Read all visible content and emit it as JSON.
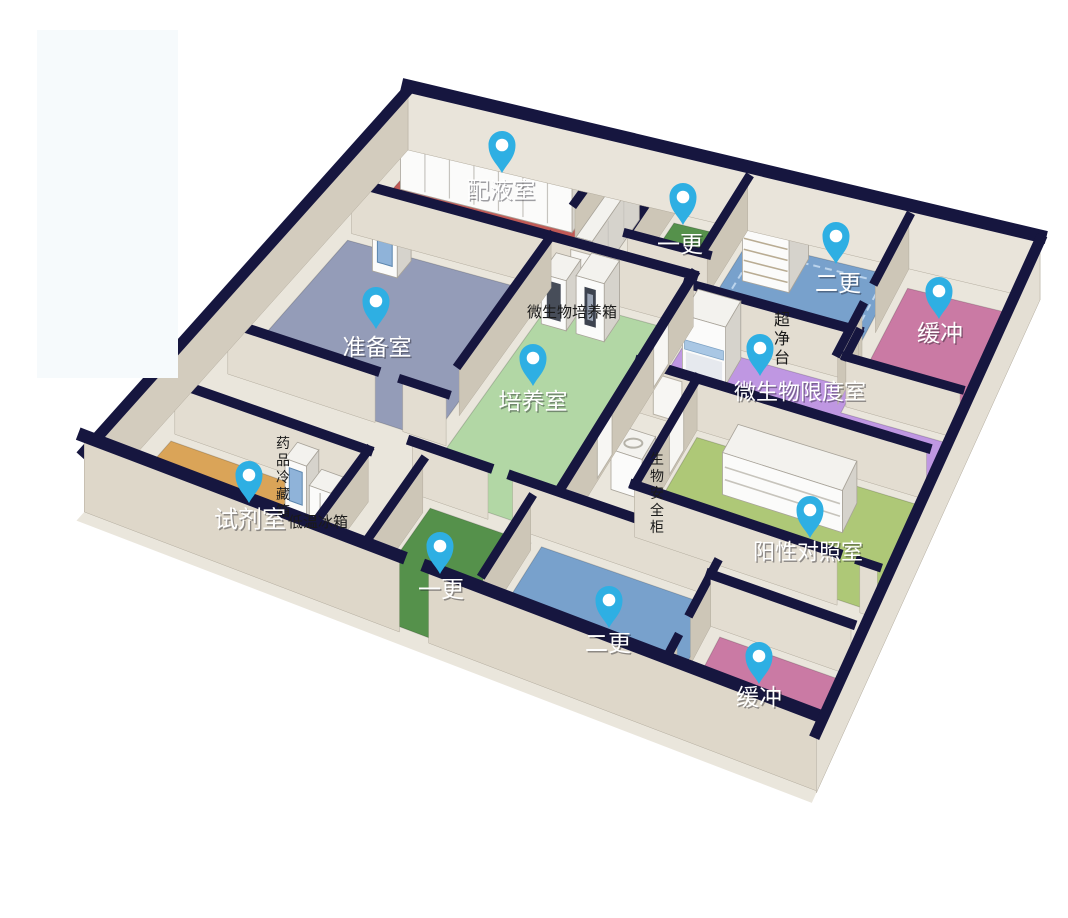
{
  "canvas": {
    "width": 1068,
    "height": 918,
    "background": "#ffffff"
  },
  "pin": {
    "color": "#2eafe3",
    "inner_color": "#ffffff"
  },
  "palette": {
    "wall_top": "#16163f",
    "wall_face_light": "#e7e1d6",
    "wall_face_dark": "#cdc6b7",
    "slab": "#eae6dc"
  },
  "rooms": [
    {
      "id": "peiye",
      "label": "配液室",
      "floor_color": "#c15a56",
      "pin": {
        "x": 502,
        "y": 172
      },
      "label_pos": {
        "x": 501,
        "y": 190
      },
      "label_size": 23,
      "poly": [
        [
          0.5,
          0.3
        ],
        [
          6.3,
          0.3
        ],
        [
          6.3,
          3.0
        ],
        [
          0.5,
          3.0
        ]
      ]
    },
    {
      "id": "yigeng-top",
      "label": "一更",
      "floor_color": "#55914b",
      "pin": {
        "x": 683,
        "y": 224
      },
      "label_pos": {
        "x": 680,
        "y": 244
      },
      "label_size": 23,
      "poly": [
        [
          8.6,
          0.3
        ],
        [
          10.6,
          0.3
        ],
        [
          10.6,
          2.3
        ],
        [
          8.6,
          2.3
        ]
      ]
    },
    {
      "id": "ergeng-top",
      "label": "二更",
      "floor_color": "#78a1cc",
      "pin": {
        "x": 836,
        "y": 263
      },
      "label_pos": {
        "x": 838,
        "y": 283
      },
      "label_size": 23,
      "poly": [
        [
          10.95,
          0.3
        ],
        [
          15.6,
          0.3
        ],
        [
          15.6,
          3.3
        ],
        [
          10.95,
          3.3
        ]
      ]
    },
    {
      "id": "huanchong-top",
      "label": "缓冲",
      "floor_color": "#ca7aa4",
      "pin": {
        "x": 939,
        "y": 318
      },
      "label_pos": {
        "x": 940,
        "y": 333
      },
      "label_size": 23,
      "poly": [
        [
          16.1,
          0.55
        ],
        [
          19.5,
          0.55
        ],
        [
          19.5,
          4.2
        ],
        [
          16.1,
          4.2
        ]
      ]
    },
    {
      "id": "zhunbei",
      "label": "准备室",
      "floor_color": "#949cb8",
      "pin": {
        "x": 376,
        "y": 328
      },
      "label_pos": {
        "x": 377,
        "y": 347
      },
      "label_size": 23,
      "poly": [
        [
          0.5,
          3.45
        ],
        [
          6.3,
          3.45
        ],
        [
          6.3,
          8.75
        ],
        [
          0.5,
          8.75
        ]
      ]
    },
    {
      "id": "peiyang",
      "label": "培养室",
      "floor_color": "#b2d7a5",
      "pin": {
        "x": 533,
        "y": 385
      },
      "label_pos": {
        "x": 533,
        "y": 401
      },
      "label_size": 23,
      "poly": [
        [
          6.8,
          3.45
        ],
        [
          10.85,
          3.45
        ],
        [
          10.85,
          10.3
        ],
        [
          6.8,
          10.3
        ]
      ]
    },
    {
      "id": "weishengwu-xiandu",
      "label": "微生物限度室",
      "floor_color": "#bf97e2",
      "pin": {
        "x": 760,
        "y": 375
      },
      "label_pos": {
        "x": 800,
        "y": 392
      },
      "label_size": 22,
      "poly": [
        [
          10.95,
          3.7
        ],
        [
          16.05,
          3.7
        ],
        [
          16.05,
          4.45
        ],
        [
          19.5,
          4.45
        ],
        [
          19.5,
          5.95
        ],
        [
          10.95,
          5.95
        ]
      ]
    },
    {
      "id": "shiji",
      "label": "试剂室",
      "floor_color": "#daa458",
      "pin": {
        "x": 249,
        "y": 502
      },
      "label_pos": {
        "x": 250,
        "y": 519
      },
      "label_size": 24,
      "poly": [
        [
          0.5,
          11.45
        ],
        [
          5.85,
          11.45
        ],
        [
          5.85,
          14.4
        ],
        [
          0.5,
          14.4
        ]
      ]
    },
    {
      "id": "yigeng-bottom",
      "label": "一更",
      "floor_color": "#55914b",
      "pin": {
        "x": 440,
        "y": 573
      },
      "label_pos": {
        "x": 441,
        "y": 589
      },
      "label_size": 23,
      "poly": [
        [
          7.4,
          10.75
        ],
        [
          10.25,
          10.75
        ],
        [
          10.25,
          14.4
        ],
        [
          7.4,
          14.4
        ]
      ]
    },
    {
      "id": "yangxing-duizhao",
      "label": "阳性对照室",
      "floor_color": "#aec877",
      "pin": {
        "x": 810,
        "y": 537
      },
      "label_pos": {
        "x": 808,
        "y": 552
      },
      "label_size": 22,
      "poly": [
        [
          12.7,
          6.3
        ],
        [
          19.5,
          6.3
        ],
        [
          19.5,
          9.45
        ],
        [
          12.7,
          9.45
        ]
      ]
    },
    {
      "id": "ergeng-bottom",
      "label": "二更",
      "floor_color": "#78a1cc",
      "pin": {
        "x": 609,
        "y": 627
      },
      "label_pos": {
        "x": 608,
        "y": 643
      },
      "label_size": 23,
      "poly": [
        [
          10.55,
          10.75
        ],
        [
          15.5,
          10.75
        ],
        [
          15.5,
          14.4
        ],
        [
          10.55,
          14.4
        ]
      ]
    },
    {
      "id": "huanchong-bottom",
      "label": "缓冲",
      "floor_color": "#ca7aa4",
      "pin": {
        "x": 759,
        "y": 683
      },
      "label_pos": {
        "x": 759,
        "y": 697
      },
      "label_size": 23,
      "poly": [
        [
          15.95,
          11.5
        ],
        [
          19.45,
          11.5
        ],
        [
          19.45,
          14.4
        ],
        [
          15.95,
          14.4
        ]
      ]
    }
  ],
  "equipment_labels": [
    {
      "text": "微生物培养箱",
      "x": 572,
      "y": 317,
      "vertical": false,
      "size": 15
    },
    {
      "text": "超净台",
      "x": 782,
      "y": 325,
      "vertical": true,
      "size": 16
    },
    {
      "text": "药品冷藏箱",
      "x": 283,
      "y": 448,
      "vertical": true,
      "size": 14
    },
    {
      "text": "低温冰箱",
      "x": 318,
      "y": 527,
      "vertical": false,
      "size": 15
    },
    {
      "text": "生物安全柜",
      "x": 657,
      "y": 464,
      "vertical": true,
      "size": 14
    }
  ]
}
